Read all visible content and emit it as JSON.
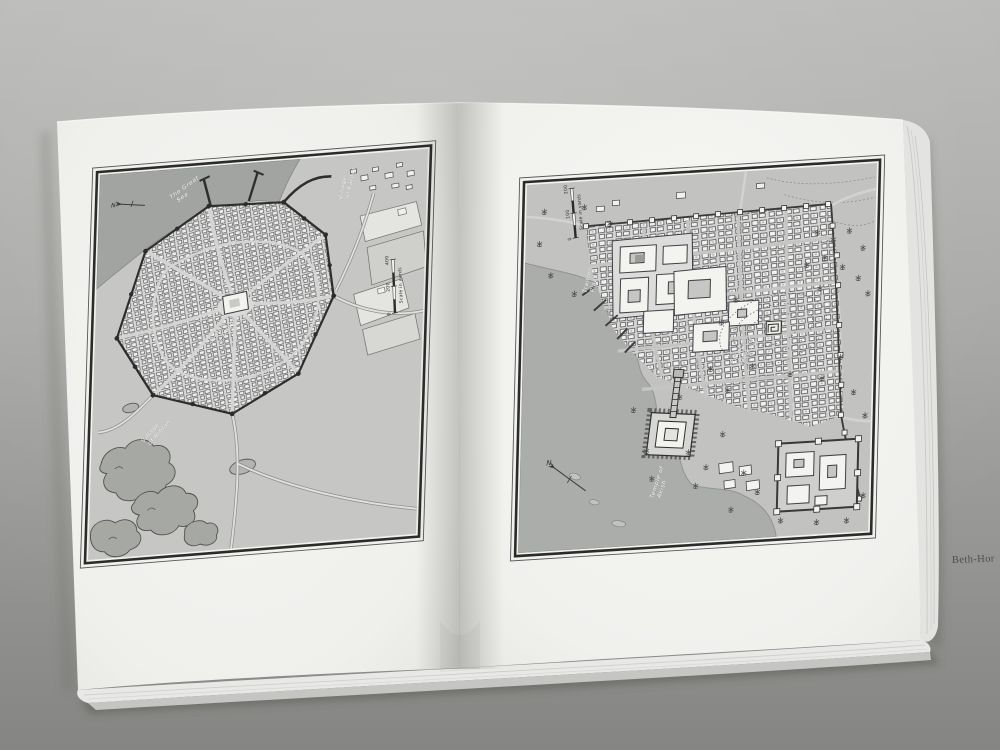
{
  "plate_caption": "Beth-Hor",
  "left_map": {
    "sea_label": [
      "The Great",
      "Sea"
    ],
    "village_ne": [
      "Village",
      "of Karpas"
    ],
    "temple_label": [
      "Temple",
      "of Dagon"
    ],
    "village_sw": [
      "Village",
      "of Riblah"
    ],
    "scale_bar": {
      "zero": "0",
      "mid": "200",
      "max": "400",
      "caption": "Scale in yards"
    },
    "north_label": "N"
  },
  "right_map": {
    "plaza_label": [
      "Traitors",
      "Plaza"
    ],
    "palace_label": [
      "Palace of",
      "Jared XVI"
    ],
    "temple_label": [
      "Temple of",
      "Akish"
    ],
    "scale_bar": {
      "zero": "0",
      "mid": "100",
      "max": "200",
      "caption": "Scale in yards"
    },
    "north_label": "N"
  },
  "colors": {
    "table_top": "#b7b7b5",
    "table_bottom": "#868684",
    "paper": "#f2f2ef",
    "map_land": "#c6c7c5",
    "map_water": "#a2a4a2",
    "ink": "#2e2e2c",
    "label_white": "#fbfbf9"
  }
}
